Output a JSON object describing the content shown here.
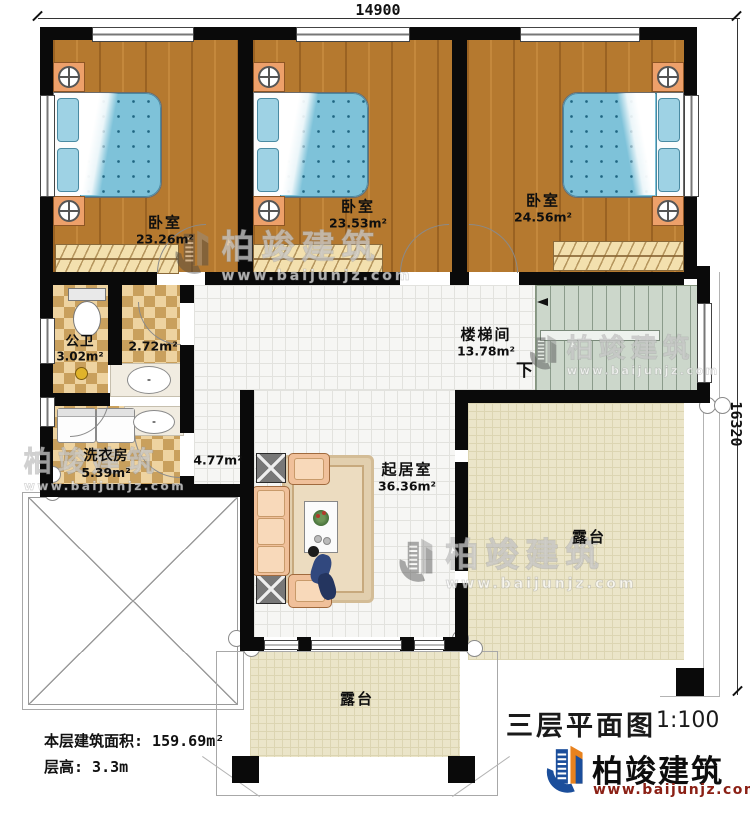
{
  "dimensions": {
    "top": "14900",
    "right": "16320"
  },
  "rooms": {
    "bedroom1": {
      "name": "卧室",
      "area": "23.26m²"
    },
    "bedroom2": {
      "name": "卧室",
      "area": "23.53m²"
    },
    "bedroom3": {
      "name": "卧室",
      "area": "24.56m²"
    },
    "bathroom": {
      "name": "公卫",
      "area": "3.02m²"
    },
    "closet": {
      "area": "2.72m²"
    },
    "laundry": {
      "name": "洗衣房",
      "area": "5.39m²"
    },
    "hallway": {
      "area": "4.77m²"
    },
    "stairwell": {
      "name": "楼梯间",
      "area": "13.78m²",
      "direction": "下"
    },
    "living": {
      "name": "起居室",
      "area": "36.36m²"
    },
    "terrace_right": {
      "name": "露台"
    },
    "terrace_bottom": {
      "name": "露台"
    }
  },
  "footer": {
    "floor_area": "本层建筑面积: 159.69m²",
    "floor_height": "层高: 3.3m"
  },
  "title_block": {
    "title": "三层平面图",
    "scale": "1:100"
  },
  "brand": {
    "name": "柏竣建筑",
    "site": "www.baijunjz.com"
  },
  "watermark": {
    "name": "柏竣建筑",
    "site": "www.baijunjz.com"
  },
  "colors": {
    "wall": "#0a0a0a",
    "wood_floor": "#b5792f",
    "tile_checker": "#eed3a0",
    "terrace": "#ebe5c9",
    "stairs": "#ccd7cb",
    "bed_blue": "#7ec2d9",
    "brand_blue": "#1b4e9b",
    "brand_orange": "#e8821e",
    "brand_red": "#8b2015"
  }
}
